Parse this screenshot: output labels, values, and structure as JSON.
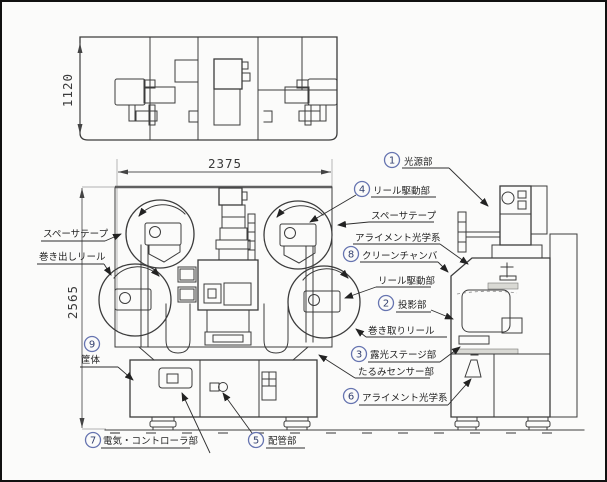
{
  "drawing": {
    "dimensions": {
      "top_view_depth": "1120",
      "front_width": "2375",
      "front_height": "2565"
    },
    "callouts": [
      {
        "num": "1",
        "label": "光源部"
      },
      {
        "num": "2",
        "label": "投影部"
      },
      {
        "num": "3",
        "label": "露光ステージ部"
      },
      {
        "num": "4",
        "label": "リール駆動部"
      },
      {
        "num": "5",
        "label": "配管部"
      },
      {
        "num": "6",
        "label": "アライメント光学系"
      },
      {
        "num": "7",
        "label": "電気・コントローラ部"
      },
      {
        "num": "8",
        "label": "クリーンチャンバ"
      },
      {
        "num": "9",
        "label": "筐体"
      }
    ],
    "part_labels": {
      "spacer_tape_left": "スペーサテープ",
      "unwind_reel": "巻き出しリール",
      "spacer_tape_right": "スペーサテープ",
      "alignment_optics_upper": "アライメント光学系",
      "reel_drive_lower": "リール駆動部",
      "takeup_reel": "巻き取りリール",
      "slack_sensor": "たるみセンサー部"
    },
    "colors": {
      "line": "#3c3c3c",
      "callout_badge": "#6674b0",
      "text": "#252525"
    }
  }
}
